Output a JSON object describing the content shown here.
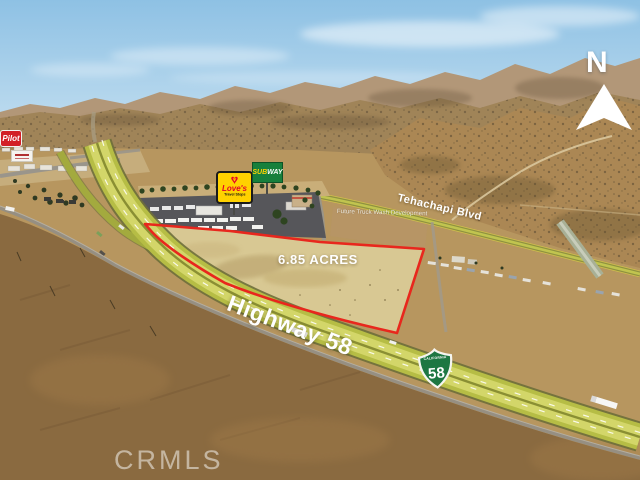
{
  "scene": {
    "description": "Aerial listing photo of a 6.85 acre land parcel outlined in red beside Highway 58 and Tehachapi Blvd in Tehachapi, California, with Love's, Subway and Pilot travel stops nearby"
  },
  "labels": {
    "acreage": "6.85 ACRES",
    "highway": "Highway 58",
    "cross_street": "Tehachapi Blvd",
    "future_development": "Future Truck Wash Development",
    "watermark": "CRMLS",
    "north_letter": "N"
  },
  "route_shield": {
    "state": "CALIFORNIA",
    "number": "58"
  },
  "signs": {
    "pilot": "Pilot",
    "loves_name": "Love's",
    "loves_tagline": "Travel Stops",
    "subway_sub": "SUB",
    "subway_way": "WAY"
  },
  "icons": {
    "heart": "♥"
  },
  "colors": {
    "parcel_outline_red": "#e8271d",
    "highway_tint_green": "#b6bd45",
    "road_outline_yellow": "#e8e33c",
    "shield_green": "#1d7742",
    "loves_yellow": "#ffd100",
    "loves_red": "#e4002b",
    "subway_green": "#17803c",
    "pilot_red": "#d21f26",
    "sky_blue": "#8ec1e4"
  }
}
